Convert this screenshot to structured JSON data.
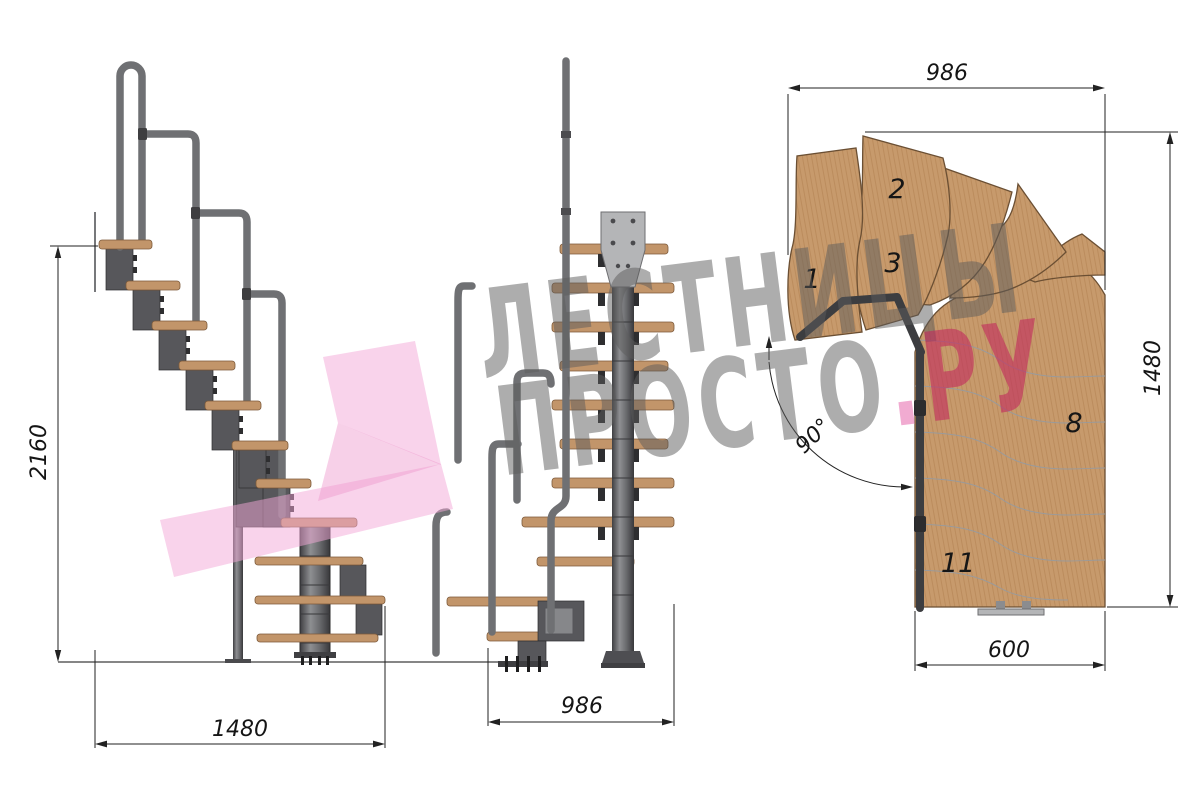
{
  "watermark": {
    "line1": "ЛЕСТНИЦЫ",
    "line2": "ПРОСТО",
    "dot": ".",
    "tld": "РУ"
  },
  "views": {
    "side": {
      "dim_height": "2160",
      "dim_length": "1480"
    },
    "front": {
      "dim_width": "986"
    },
    "plan": {
      "dim_top": "986",
      "dim_right": "1480",
      "dim_bottom": "600",
      "angle": "90°",
      "steps": [
        {
          "label": "1"
        },
        {
          "label": "2"
        },
        {
          "label": "3"
        },
        {
          "label": "8"
        },
        {
          "label": "11"
        }
      ]
    }
  },
  "colors": {
    "background": "#ffffff",
    "wood": "#c2956a",
    "wood_plan": "#c79a6c",
    "wood_edge": "#7d5a3a",
    "metal": "#57575b",
    "metal_light": "#b4b5b7",
    "rail": "#6f7073",
    "dim_line": "#222222",
    "watermark_gray": "#5c5c5c",
    "watermark_pink": "#f2a8d8",
    "watermark_red": "#c22a5d"
  }
}
